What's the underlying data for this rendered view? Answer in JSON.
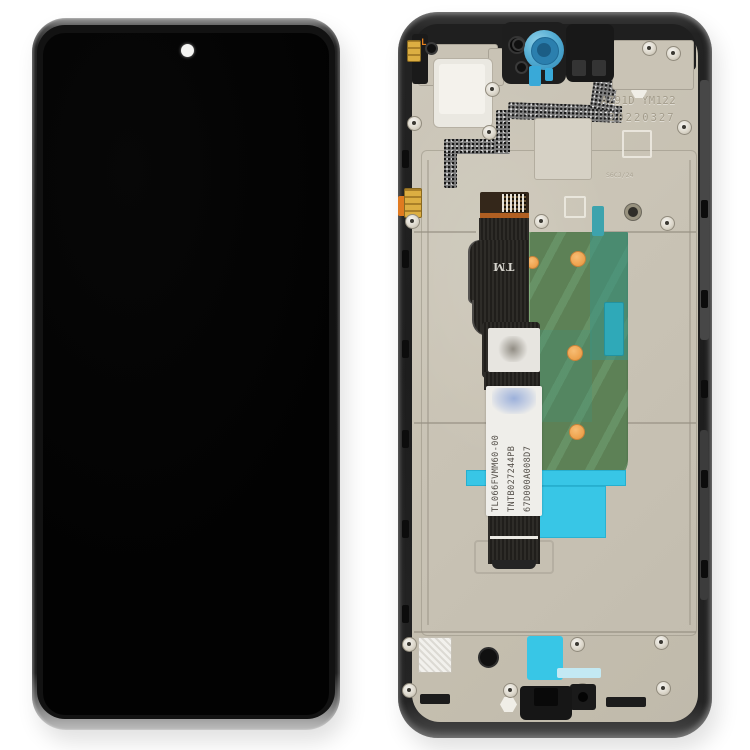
{
  "scene": {
    "description": "Phone LCD screen and digitizer full assembly with frame, front view (left) and back view (right)",
    "background_color": "#ffffff"
  },
  "front_view": {
    "screen_color": "#050505",
    "punch_hole_camera": "white-dot"
  },
  "back_view": {
    "frame_color": "#232323",
    "plate_color": "#c8c2b4",
    "engravings": {
      "faint_code": "Y16Y1",
      "alloy_code": "AZ91D YM122",
      "date_code": "20220327",
      "small_code": "S6CJ/24"
    },
    "orange_mark": "L",
    "flex": {
      "tm_mark": "TM",
      "label_lines": [
        "TL066FVMM60-00",
        "TNTB027244PB",
        "67D000A008D7"
      ]
    },
    "colors": {
      "pcb_green": "#5d8156",
      "sticker_cyan": "#38c6e6",
      "sticker_teal": "#3aa3ad",
      "pad_orange": "#efa558",
      "contact_gold": "#d9a93e",
      "camera_ring_blue": "#3e9fd0"
    }
  }
}
